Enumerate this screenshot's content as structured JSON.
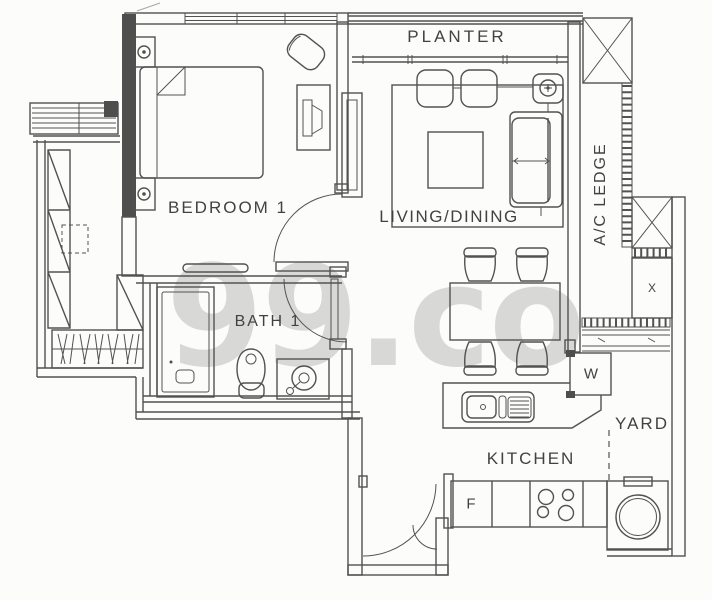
{
  "watermark": "99.co",
  "rooms": {
    "planter": "PLANTER",
    "bedroom1": "BEDROOM 1",
    "living_dining": "LIVING/DINING",
    "ac_ledge": "A/C LEDGE",
    "bath1": "BATH 1",
    "kitchen": "KITCHEN",
    "yard": "YARD"
  },
  "appliances": {
    "washer": "W",
    "fridge": "F",
    "ac_unit": "X"
  },
  "colors": {
    "background": "#fcfcfa",
    "line": "#525252",
    "wall_fill": "#4e4e4e",
    "label": "#424242",
    "watermark": "rgba(40,40,40,0.17)"
  }
}
